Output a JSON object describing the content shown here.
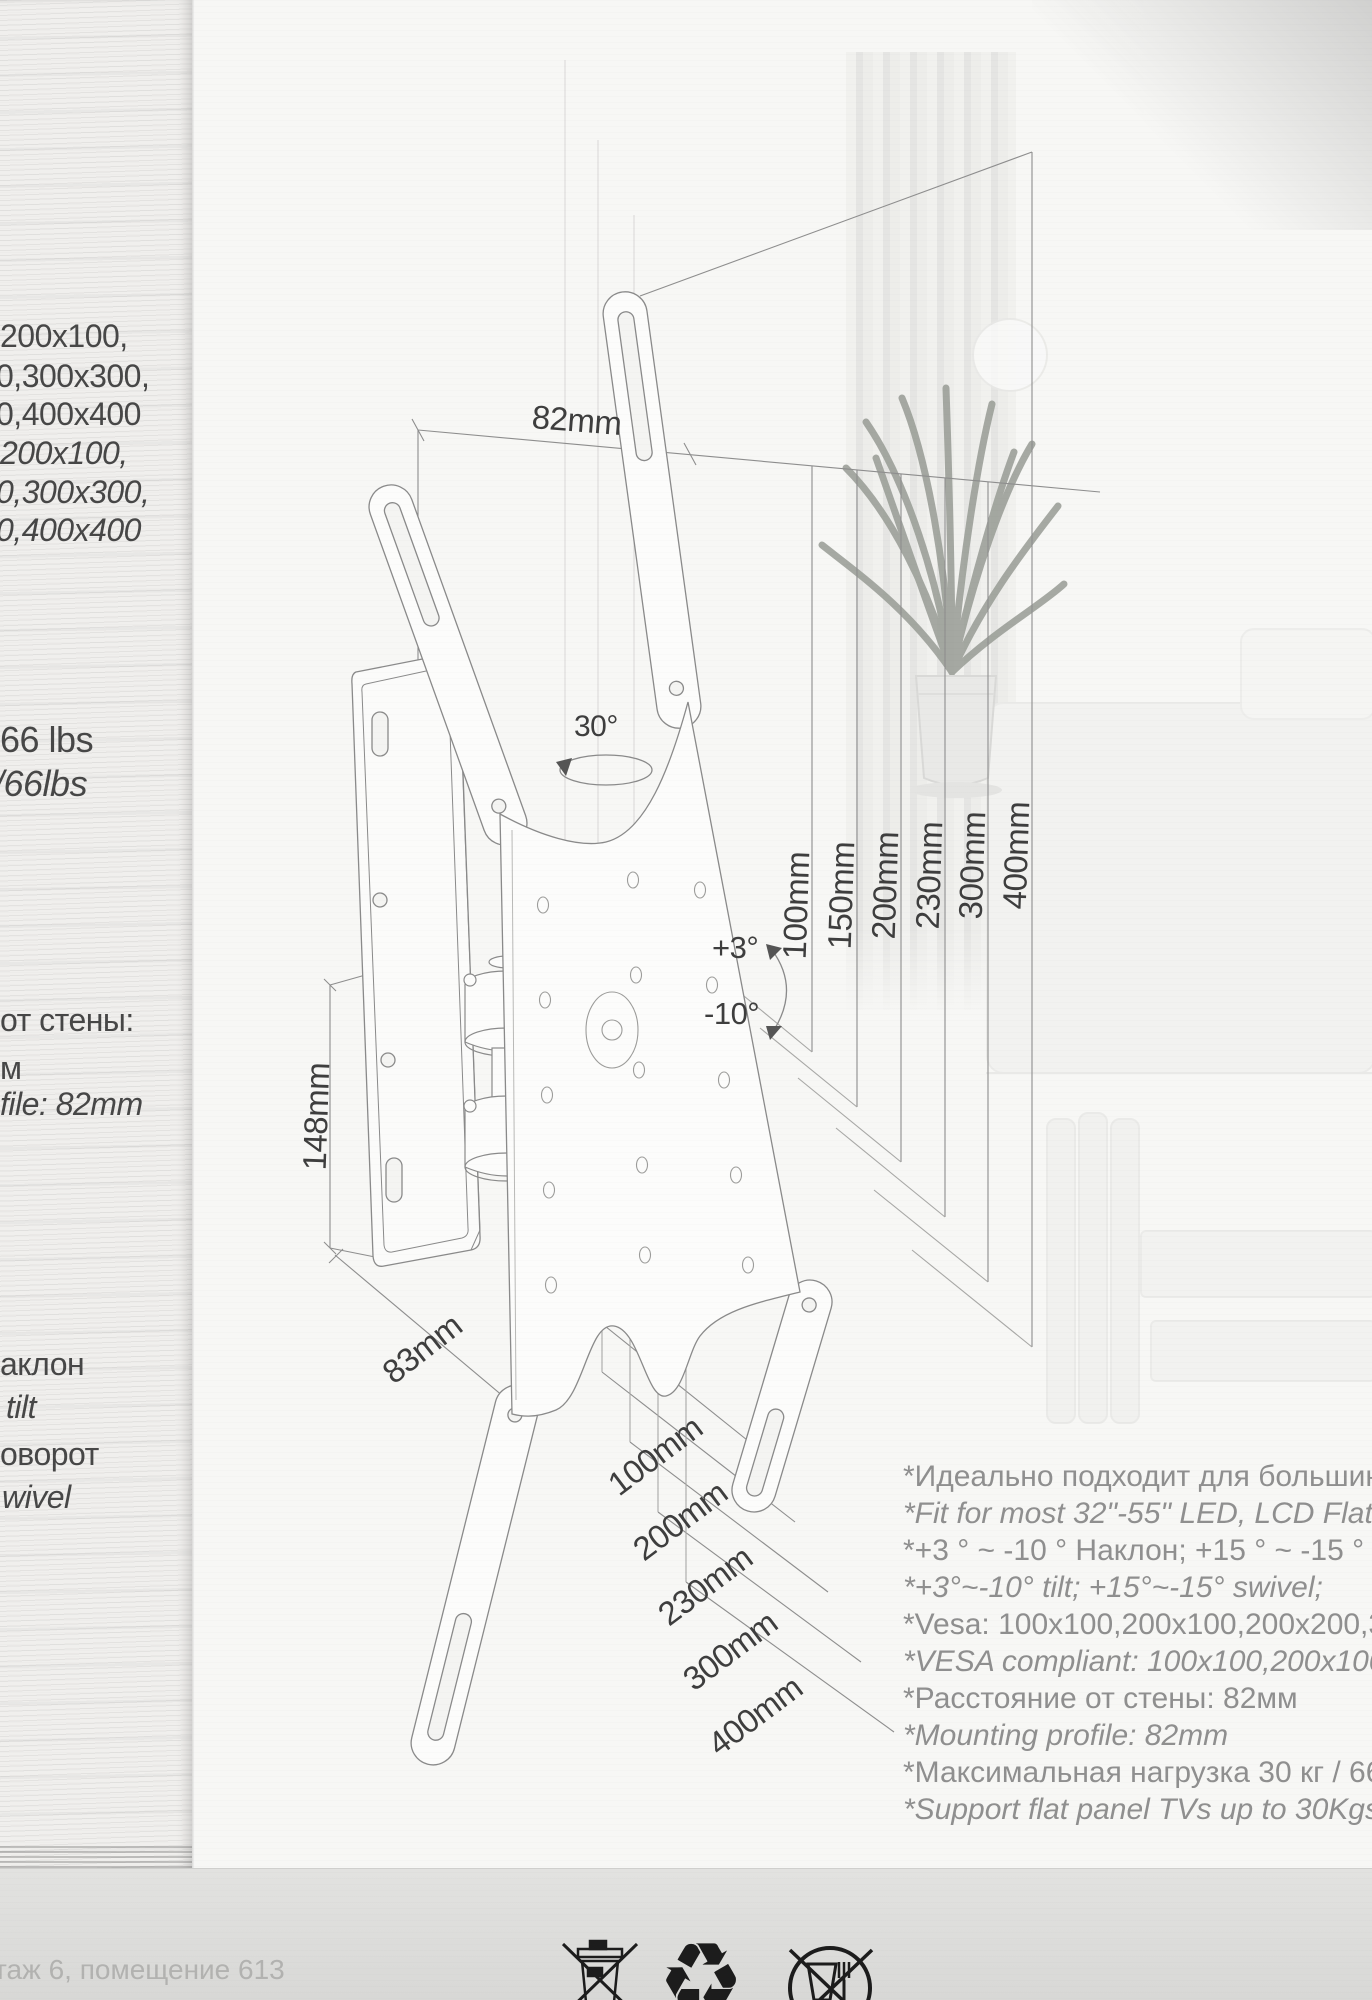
{
  "left_column": {
    "lines": [
      "200x100,",
      "0,300x300,",
      "0,400x400",
      "200x100,",
      "0,300x300,",
      "0,400x400",
      "66 lbs",
      "/66lbs",
      "от стены:",
      "м",
      "file: 82mm",
      "аклон",
      "tilt",
      "оворот",
      "wivel"
    ]
  },
  "diagram": {
    "top_depth_label": "82mm",
    "wall_plate_height_label": "148mm",
    "wall_plate_width_label": "83mm",
    "swivel_label": "30°",
    "tilt_up_label": "+3°",
    "tilt_down_label": "-10°",
    "vesa_vertical_labels": [
      "100mm",
      "150mm",
      "200mm",
      "230mm",
      "300mm",
      "400mm"
    ],
    "vesa_horizontal_labels": [
      "100mm",
      "200mm",
      "230mm",
      "300mm",
      "400mm"
    ]
  },
  "specs": {
    "lines": [
      "*Идеально подходит для большин",
      "*Fit for most 32\"-55\" LED, LCD Flat",
      "*+3 ° ~ -10 ° Наклон; +15 ° ~ -15 ° П",
      "*+3°~-10° tilt; +15°~-15° swivel;",
      "*Vesa: 100x100,200x100,200x200,3",
      "*VESA compliant: 100x100,200x100",
      "*Расстояние от стены: 82мм",
      "*Mounting profile: 82mm",
      "*Максимальная нагрузка 30 кг / 66",
      "*Support flat panel TVs up to 30Kgs"
    ]
  },
  "footer": {
    "address_fragment": "таж 6, помещение 613",
    "recycle_glyph": "♻",
    "icons": {
      "weee": "crossed-out-wheelie-bin",
      "recycle": "recycling-mobius-loop",
      "no_food": "crossed-out-glass-and-fork"
    }
  }
}
